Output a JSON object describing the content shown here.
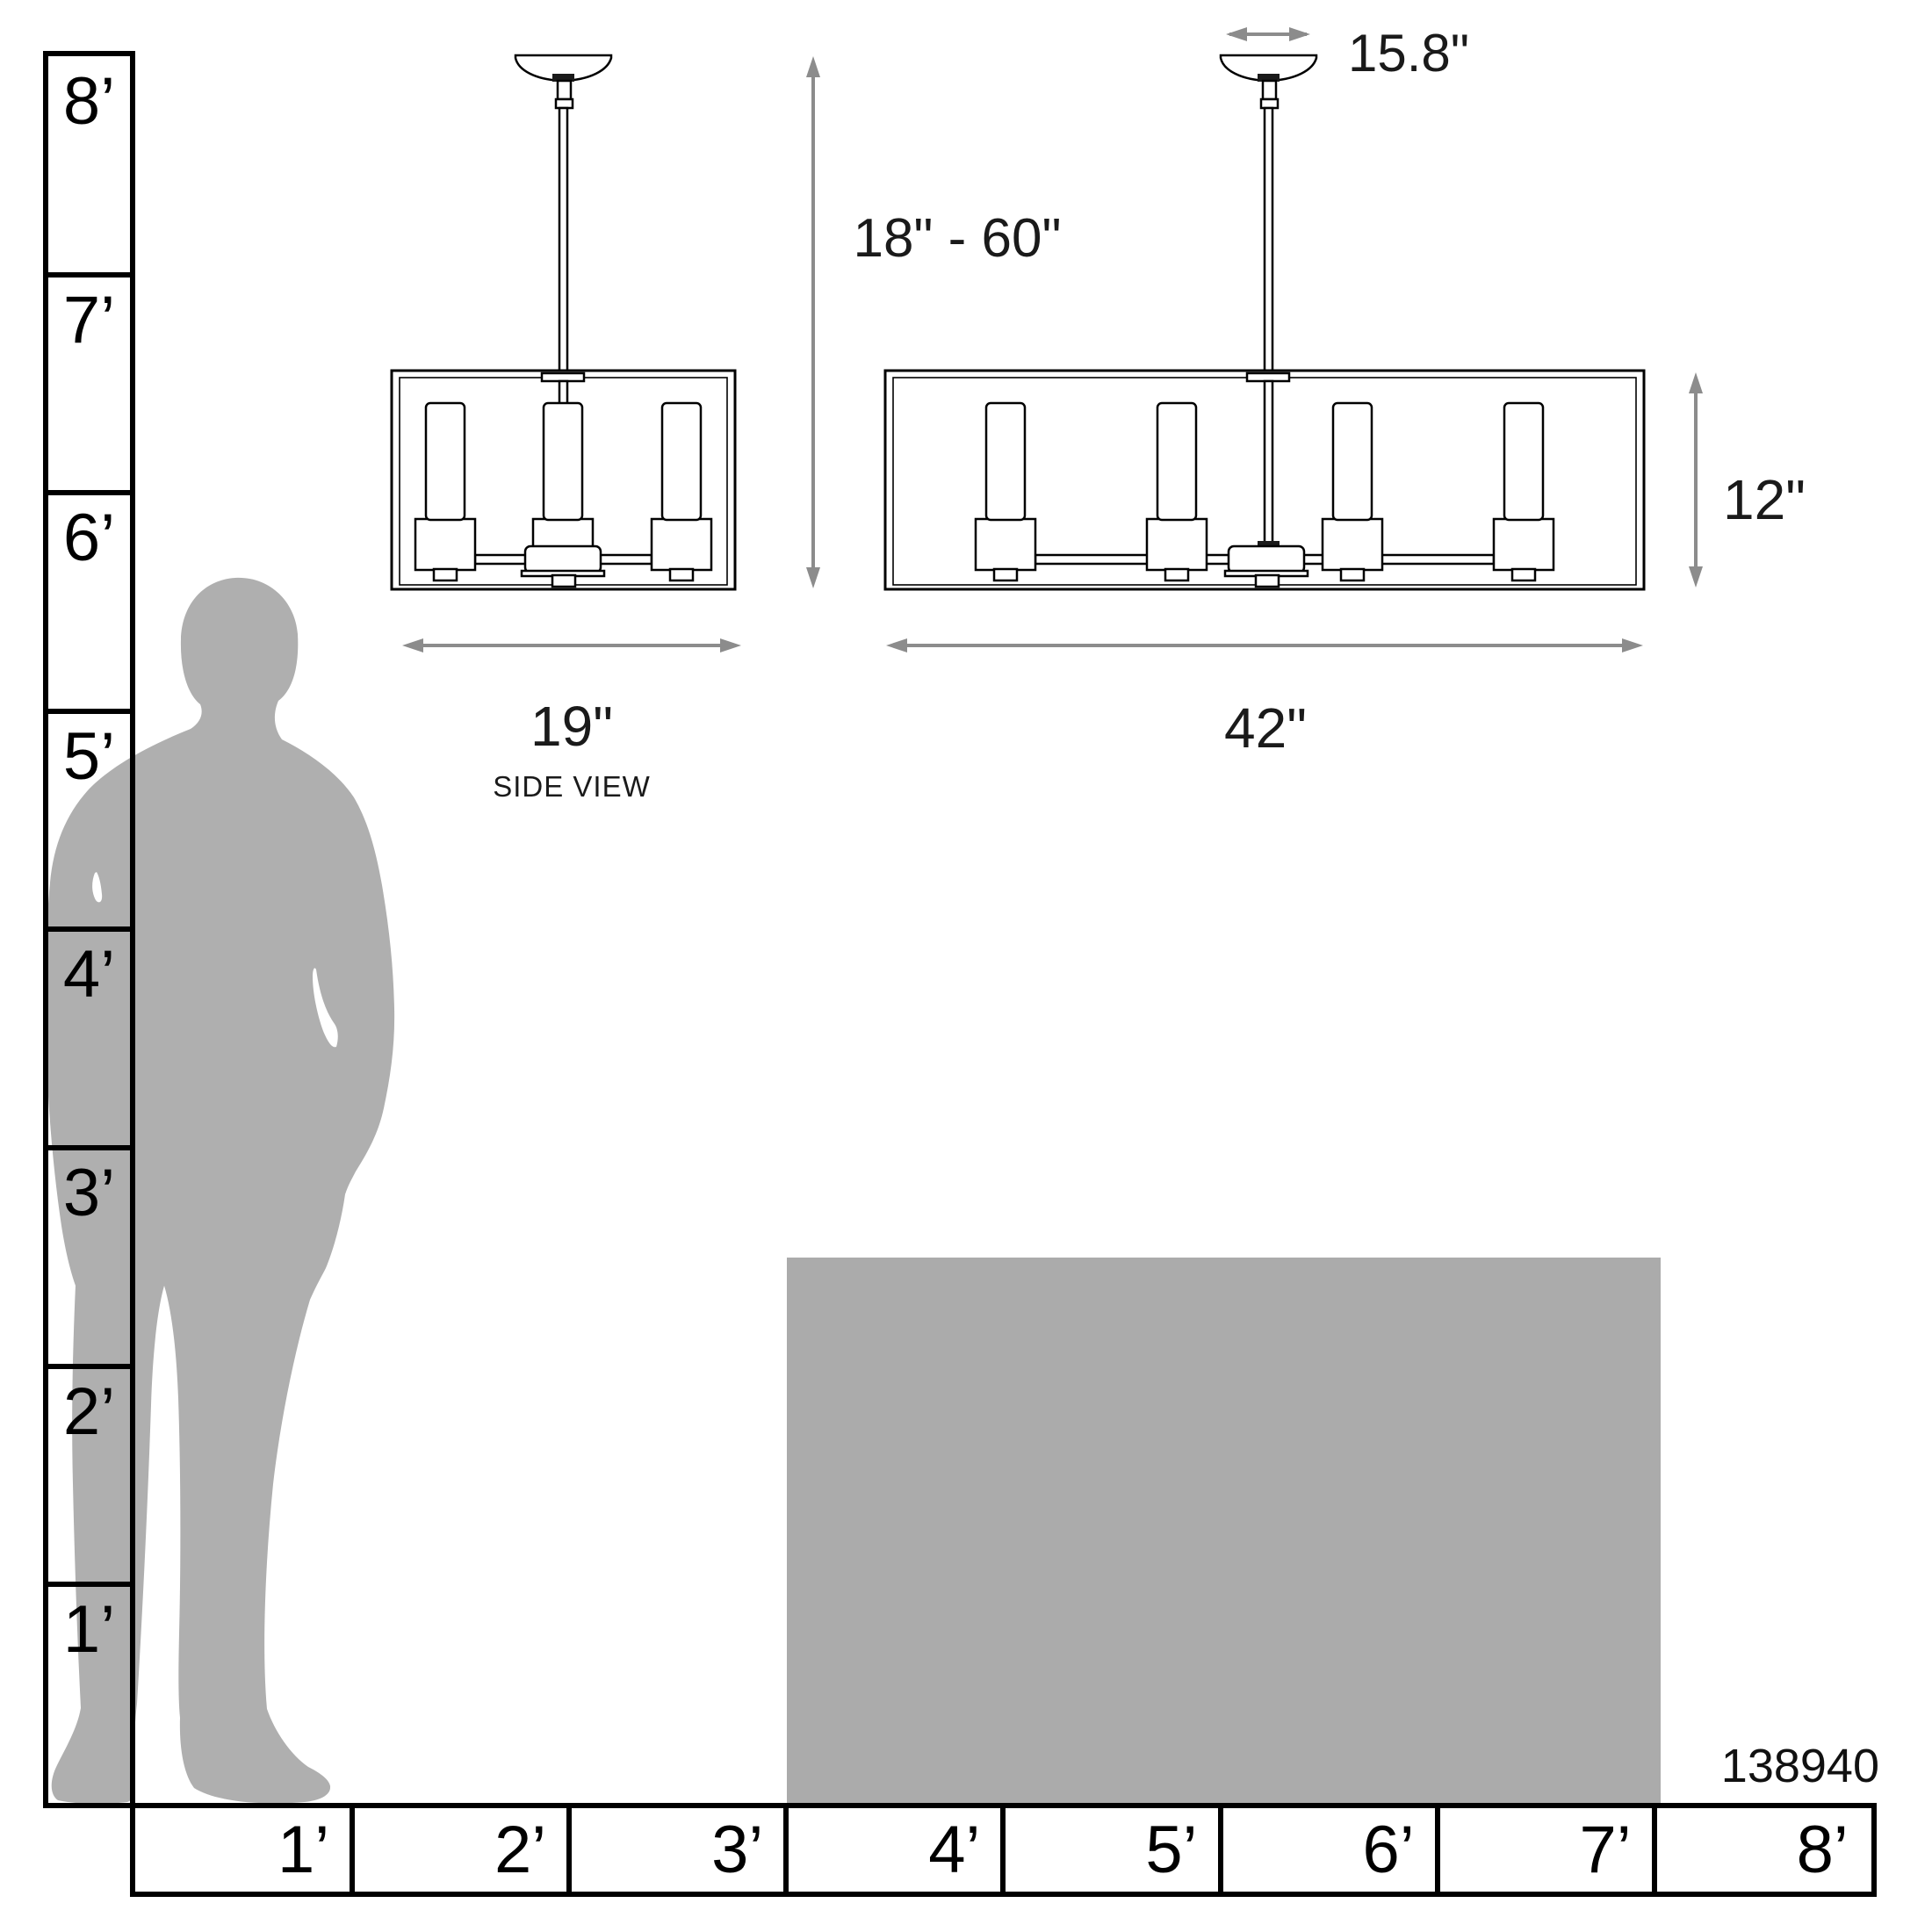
{
  "page": {
    "title": "Linear chandelier scale / dimensions diagram"
  },
  "product_number": "138940",
  "side_view": {
    "width_label": "19\"",
    "caption": "SIDE VIEW"
  },
  "front_view": {
    "canopy_width_label": "15.8\"",
    "suspension_label": "18\" - 60\"",
    "height_label": "12\"",
    "width_label": "42\""
  },
  "rulers": {
    "vertical": {
      "labels": [
        "8’",
        "7’",
        "6’",
        "5’",
        "4’",
        "3’",
        "2’",
        "1’"
      ]
    },
    "horizontal": {
      "labels": [
        "1’",
        "2’",
        "3’",
        "4’",
        "5’",
        "6’",
        "7’",
        "8’"
      ]
    }
  },
  "icons": {
    "silhouette": "standing-man-silhouette",
    "table": "scale-reference-block",
    "arrows": "double-headed-dimension-arrow"
  },
  "colors": {
    "line": "#000000",
    "dimension_text": "#1a1a1a",
    "arrow": "#8c8c8c",
    "silhouette": "#afafaf",
    "table": "#ababab"
  }
}
